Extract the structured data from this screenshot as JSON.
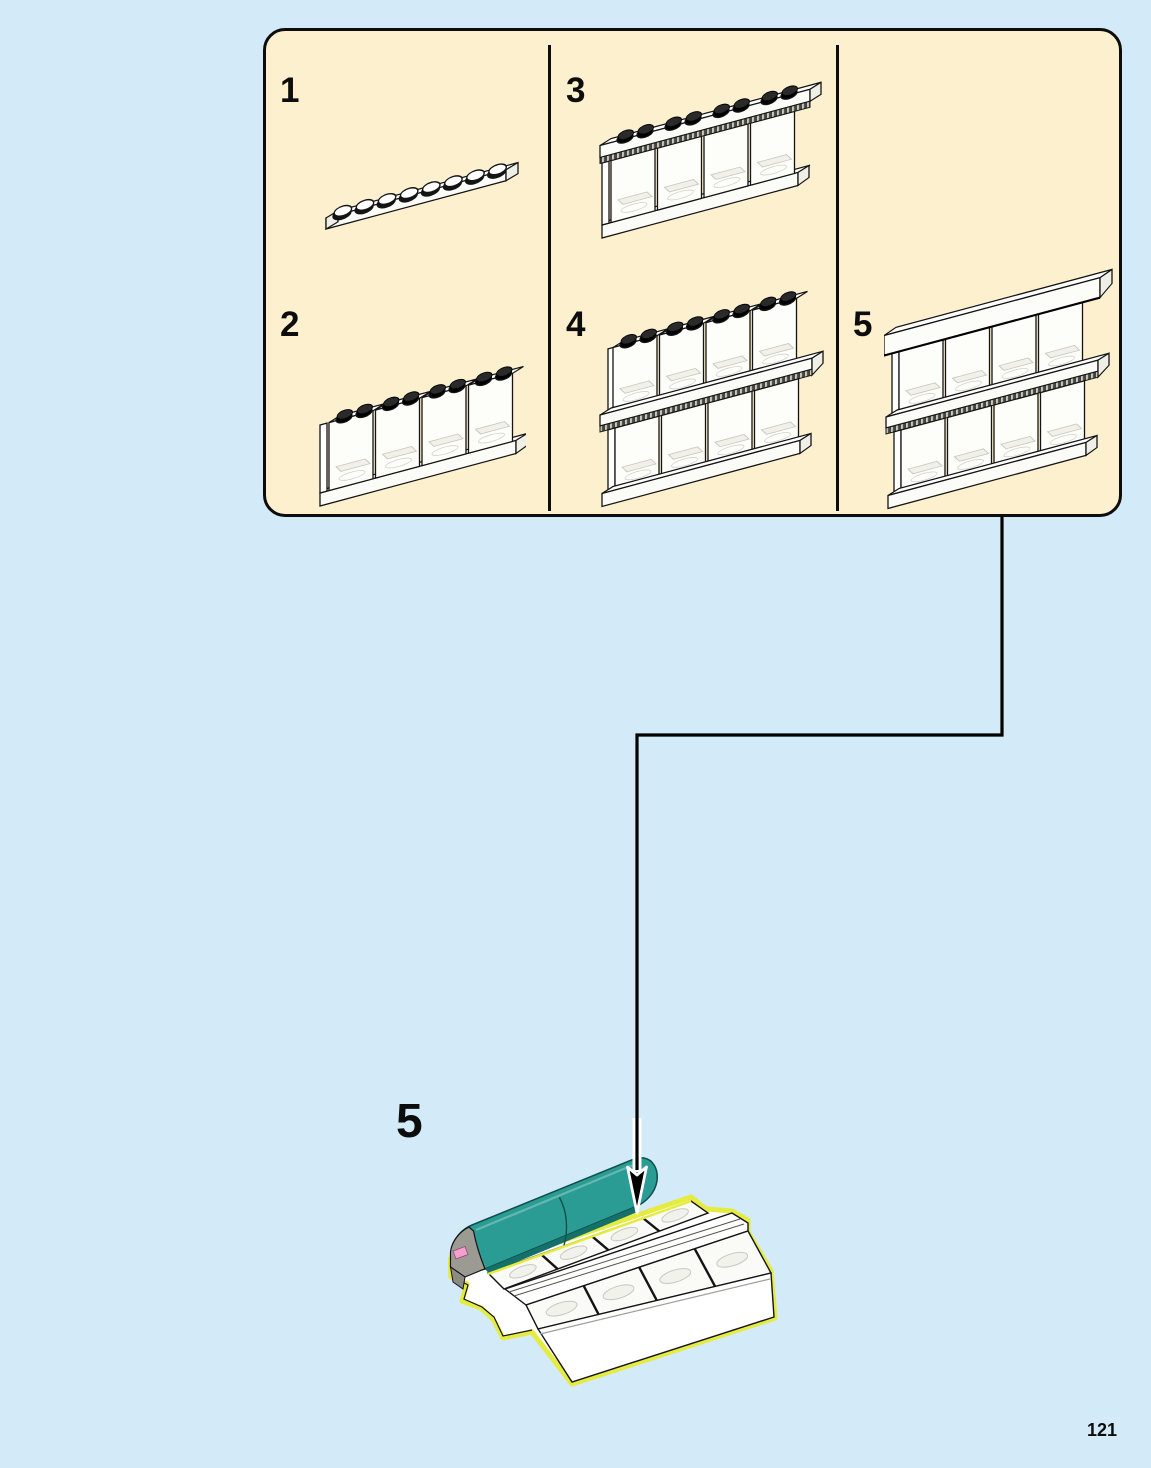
{
  "page": {
    "number": "121"
  },
  "colors": {
    "background": "#d3eaf8",
    "panel": "#fcf0cf",
    "ink": "#0d0d0d",
    "teal": "#2a9c94",
    "teal_dark": "#16706a",
    "teal_edge": "#0e4f4b",
    "grey_cap": "#9b9b93",
    "pink": "#f4a0ce",
    "highlight_yellow": "#e6eb3f"
  },
  "panel": {
    "steps": [
      {
        "label": "1",
        "part": "white-1x8-plate"
      },
      {
        "label": "2",
        "part": "display-case-row-with-black-studs"
      },
      {
        "label": "3",
        "part": "display-case-row-with-grille-plate"
      },
      {
        "label": "4",
        "part": "stacked-display-case-rows"
      },
      {
        "label": "5",
        "part": "stacked-display-case-rows-with-top-beam"
      }
    ]
  },
  "main_step": {
    "label": "5",
    "part": "teal-awning-tray-assembly"
  }
}
